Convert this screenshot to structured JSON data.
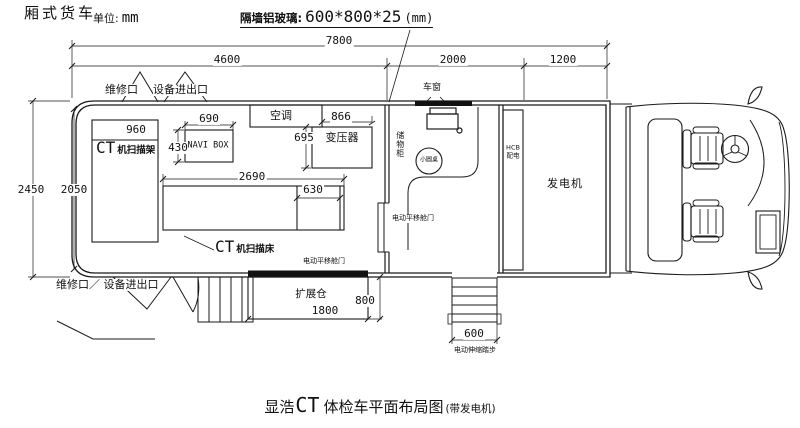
{
  "title_block": {
    "vehicle_type": "厢式货车",
    "unit_prefix": "单位:",
    "unit_value": "mm",
    "glass_note_prefix": "隔墙铝玻璃:",
    "glass_note_value": "600*800*25",
    "glass_note_suffix": "(mm)"
  },
  "dims": {
    "total_length": "7800",
    "rear_section": "4600",
    "mid_section": "2000",
    "front_section": "1200",
    "body_height_outer": "2450",
    "body_height_inner": "2050",
    "gantry_width": "960",
    "navi_box_width": "690",
    "navi_box_depth": "430",
    "transformer_width": "866",
    "transformer_depth": "695",
    "bed_length": "2690",
    "bed_width": "630",
    "expansion_length": "1800",
    "expansion_depth": "800",
    "steps_width": "600"
  },
  "doors": {
    "top_maintenance": "维修口",
    "top_equipment": "设备进出口",
    "bottom_access": "维修口／ 设备进出口",
    "scan_room_door": "电动平移舱门",
    "expansion_door": "电动平移舱门",
    "steps_label": "电动伸缩踏步"
  },
  "equipment": {
    "ct_prefix": "CT",
    "gantry": "机扫描架",
    "bed": "机扫描床",
    "navi_box": "NAVI BOX",
    "air_conditioner": "空调",
    "transformer": "变压器",
    "window": "车窗",
    "cabinet": "储物柜",
    "round_table": "小圆桌",
    "power_box_line1": "HCB",
    "power_box_line2": "配电",
    "generator": "发电机",
    "expansion_bay": "扩展仓"
  },
  "caption": {
    "brand": "显浩",
    "ct": "CT",
    "title": "体检车平面布局图",
    "suffix": "(带发电机)"
  }
}
